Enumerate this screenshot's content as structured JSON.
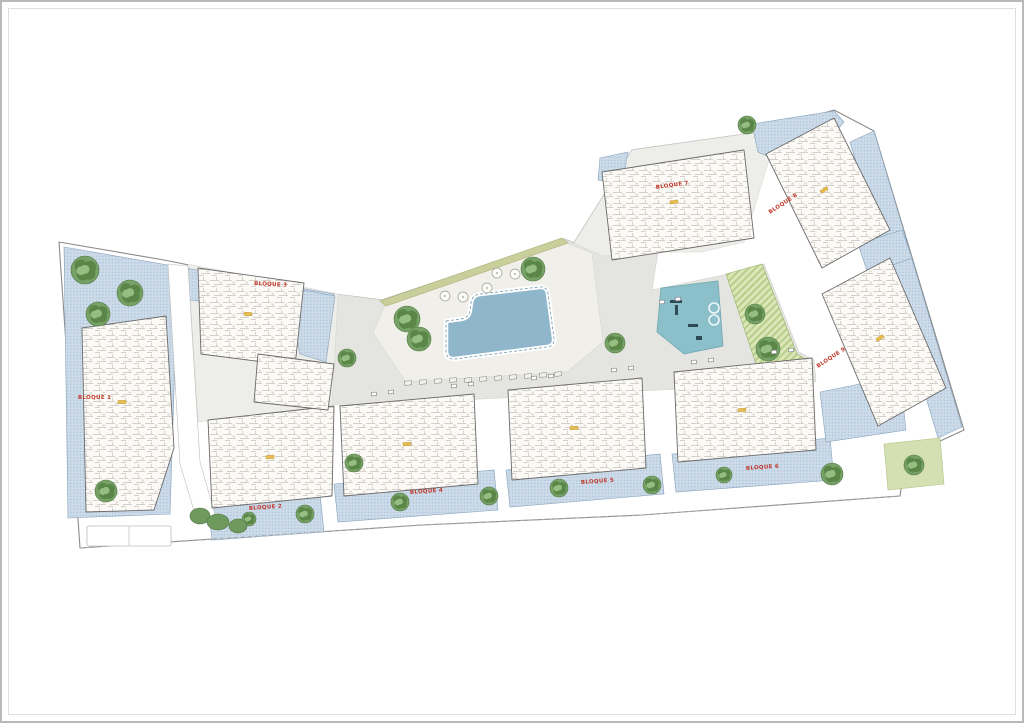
{
  "document": {
    "type": "architectural-site-plan",
    "description": "Planta general de conjunto residencial con piscina, zona de juegos y bloques de viviendas"
  },
  "palette": {
    "outline": "#8a8a8a",
    "lineLight": "#bdbdbd",
    "paving": "#e4e4e0",
    "paving2": "#ededea",
    "terrace": "#f0efe9",
    "blueEdge": "#86a2bb",
    "lawn": "#d4dfb2",
    "lawnEdge": "#b3c488",
    "hatchEdge": "#9ab06f",
    "olive": "#c9cf9b",
    "pool": "#8fb6ca",
    "poolEdge": "#7ba3ba",
    "play": "#8bc0ca",
    "playEdge": "#6fa6b2",
    "buildingEdge": "#6a6a6a",
    "stair": "#e7bd4f",
    "label": "#c0392b",
    "treeBase": "#76a268",
    "treeDark": "#5a8648",
    "treeLight": "#96bd82",
    "treeEdge": "#53793f"
  },
  "plan": {
    "site_outline": "57,240 162,258 332,292 380,298 562,237 572,241 630,148 758,130 832,108 872,129 962,428 936,440 940,460 902,468 898,494 640,513 420,523 78,546",
    "boundary_dash": "78,546 420,523 640,513 898,494",
    "areas": [
      {
        "name": "parcel-ground-center",
        "kind": "paving",
        "points": "333,292 380,298 562,237 572,241 600,254 656,250 650,288 726,272 762,262 797,350 812,358 814,380 340,404 330,402"
      },
      {
        "name": "parcel-ground-top",
        "kind": "paving2",
        "points": "572,241 630,148 758,130 770,148 742,240 700,250 656,250 600,254"
      },
      {
        "name": "parcel-ground-bloque3",
        "kind": "paving2",
        "points": "186,262 336,292 330,404 196,420"
      },
      {
        "name": "pool-terrace",
        "kind": "terrace",
        "points": "384,301 562,240 590,251 601,340 565,370 404,380 371,331"
      },
      {
        "name": "garden-left",
        "kind": "blue",
        "points": "62,245 332,292 326,318 175,296 168,512 66,516"
      },
      {
        "name": "garden-bloque3-east",
        "kind": "blue",
        "points": "284,285 333,294 324,360 298,352 290,312"
      },
      {
        "name": "patio-bloque2",
        "kind": "blue",
        "points": "206,502 318,492 322,530 210,538"
      },
      {
        "name": "patio-bloque4",
        "kind": "blue",
        "points": "332,482 492,468 496,508 336,520"
      },
      {
        "name": "patio-bloque5",
        "kind": "blue",
        "points": "504,468 658,452 662,492 508,505"
      },
      {
        "name": "patio-bloque6",
        "kind": "blue",
        "points": "670,452 828,436 832,478 674,490"
      },
      {
        "name": "garden-top-west",
        "kind": "blue",
        "points": "598,156 626,150 620,182 596,178"
      },
      {
        "name": "garden-top-corner",
        "kind": "blue",
        "points": "750,122 832,109 842,120 800,170 756,150"
      },
      {
        "name": "garden-right-strip",
        "kind": "blue",
        "points": "848,140 872,129 960,425 936,436"
      },
      {
        "name": "garden-mid-right",
        "kind": "blue",
        "points": "856,242 900,228 910,256 866,272"
      },
      {
        "name": "garden-bottom-right",
        "kind": "blue",
        "points": "818,390 898,374 904,428 824,440"
      },
      {
        "name": "lawn-bottom-right",
        "kind": "green",
        "points": "882,442 938,436 942,482 886,488"
      },
      {
        "name": "hatch-playground-strip",
        "kind": "hatch",
        "points": "724,272 760,262 795,352 808,360 756,368"
      },
      {
        "name": "olive-strip",
        "kind": "olive",
        "points": "378,299 560,236 566,241 384,304"
      },
      {
        "name": "road-left",
        "kind": "road",
        "points": "166,262 186,264 198,460 214,516 196,522 178,462"
      }
    ],
    "buildings": [
      {
        "name": "bloque-1",
        "points": "80,326 164,314 172,446 152,508 84,510"
      },
      {
        "name": "bloque-2",
        "points": "206,418 332,404 330,494 210,506"
      },
      {
        "name": "bloque-3",
        "points": "196,266 302,281 293,364 199,352"
      },
      {
        "name": "bloque-3-annex",
        "points": "256,352 332,362 326,408 252,400"
      },
      {
        "name": "bloque-4",
        "points": "338,404 472,392 476,482 342,494"
      },
      {
        "name": "bloque-5",
        "points": "506,388 640,376 644,466 510,478"
      },
      {
        "name": "bloque-6",
        "points": "672,370 810,356 814,448 676,460"
      },
      {
        "name": "bloque-7",
        "points": "600,170 742,148 752,236 610,258"
      },
      {
        "name": "bloque-8",
        "points": "764,152 832,116 888,228 820,266"
      },
      {
        "name": "bloque-9",
        "points": "820,292 888,256 944,386 876,424"
      }
    ],
    "labels": [
      {
        "text": "BLOQUE 1",
        "x": 76,
        "y": 397,
        "rot": 0
      },
      {
        "text": "BLOQUE 2",
        "x": 247,
        "y": 508,
        "rot": -4
      },
      {
        "text": "BLOQUE 3",
        "x": 252,
        "y": 283,
        "rot": 3
      },
      {
        "text": "BLOQUE 4",
        "x": 408,
        "y": 492,
        "rot": -4
      },
      {
        "text": "BLOQUE 5",
        "x": 579,
        "y": 482,
        "rot": -4
      },
      {
        "text": "BLOQUE 6",
        "x": 744,
        "y": 468,
        "rot": -4
      },
      {
        "text": "BLOQUE 7",
        "x": 654,
        "y": 187,
        "rot": -8
      },
      {
        "text": "BLOQUE 8",
        "x": 768,
        "y": 212,
        "rot": -33
      },
      {
        "text": "BLOQUE 9",
        "x": 816,
        "y": 366,
        "rot": -33
      }
    ],
    "pool": {
      "path": "M444,319 L459,317 Q467,316 468,308 L469,301 Q470,293 478,292 L537,285 Q545,284 546,292 L552,336 Q553,344 545,345 L453,357 Q445,358 444,350 Z"
    },
    "playground": {
      "points": "659,286 716,279 721,344 682,352 655,330",
      "marks": [
        {
          "x": 668,
          "y": 298,
          "w": 12,
          "h": 3
        },
        {
          "x": 673,
          "y": 303,
          "w": 3,
          "h": 10
        },
        {
          "x": 686,
          "y": 322,
          "w": 10,
          "h": 3
        },
        {
          "x": 694,
          "y": 334,
          "w": 6,
          "h": 4
        }
      ],
      "rings": [
        [
          712,
          306
        ],
        [
          712,
          318
        ]
      ]
    },
    "trees": [
      [
        83,
        268,
        14
      ],
      [
        128,
        291,
        13
      ],
      [
        96,
        312,
        12
      ],
      [
        104,
        489,
        11
      ],
      [
        247,
        517,
        7
      ],
      [
        303,
        512,
        9
      ],
      [
        352,
        461,
        9
      ],
      [
        398,
        500,
        9
      ],
      [
        487,
        494,
        9
      ],
      [
        557,
        486,
        9
      ],
      [
        650,
        483,
        9
      ],
      [
        722,
        473,
        8
      ],
      [
        830,
        472,
        11
      ],
      [
        912,
        463,
        10
      ],
      [
        405,
        317,
        13
      ],
      [
        417,
        337,
        12
      ],
      [
        531,
        267,
        12
      ],
      [
        613,
        341,
        10
      ],
      [
        345,
        356,
        9
      ],
      [
        753,
        312,
        10
      ],
      [
        766,
        347,
        12
      ],
      [
        745,
        123,
        9
      ]
    ],
    "shrubs": [
      [
        198,
        514,
        10,
        8
      ],
      [
        216,
        520,
        11,
        8
      ],
      [
        236,
        524,
        9,
        7
      ]
    ],
    "parasols": [
      [
        495,
        271
      ],
      [
        513,
        272
      ],
      [
        485,
        286
      ],
      [
        443,
        294
      ],
      [
        461,
        295
      ]
    ],
    "loungers": [
      [
        406,
        381
      ],
      [
        421,
        380
      ],
      [
        436,
        379
      ],
      [
        451,
        378
      ],
      [
        466,
        378
      ],
      [
        481,
        377
      ],
      [
        496,
        376
      ],
      [
        511,
        375
      ],
      [
        526,
        374
      ],
      [
        541,
        373
      ],
      [
        556,
        372
      ]
    ],
    "benches": [
      [
        372,
        392
      ],
      [
        389,
        390
      ],
      [
        452,
        384
      ],
      [
        469,
        382
      ],
      [
        532,
        376
      ],
      [
        549,
        374
      ],
      [
        612,
        368
      ],
      [
        629,
        366
      ],
      [
        692,
        360
      ],
      [
        709,
        358
      ],
      [
        772,
        350
      ],
      [
        789,
        348
      ],
      [
        660,
        300
      ],
      [
        676,
        297
      ]
    ],
    "stairs": [
      [
        120,
        400,
        0
      ],
      [
        268,
        455,
        -4
      ],
      [
        246,
        312,
        4
      ],
      [
        405,
        442,
        -4
      ],
      [
        572,
        426,
        -4
      ],
      [
        740,
        408,
        -4
      ],
      [
        672,
        200,
        -8
      ],
      [
        822,
        188,
        -33
      ],
      [
        878,
        336,
        -33
      ]
    ],
    "parking": {
      "x": 85,
      "y": 524,
      "w": 84,
      "h": 20
    }
  }
}
